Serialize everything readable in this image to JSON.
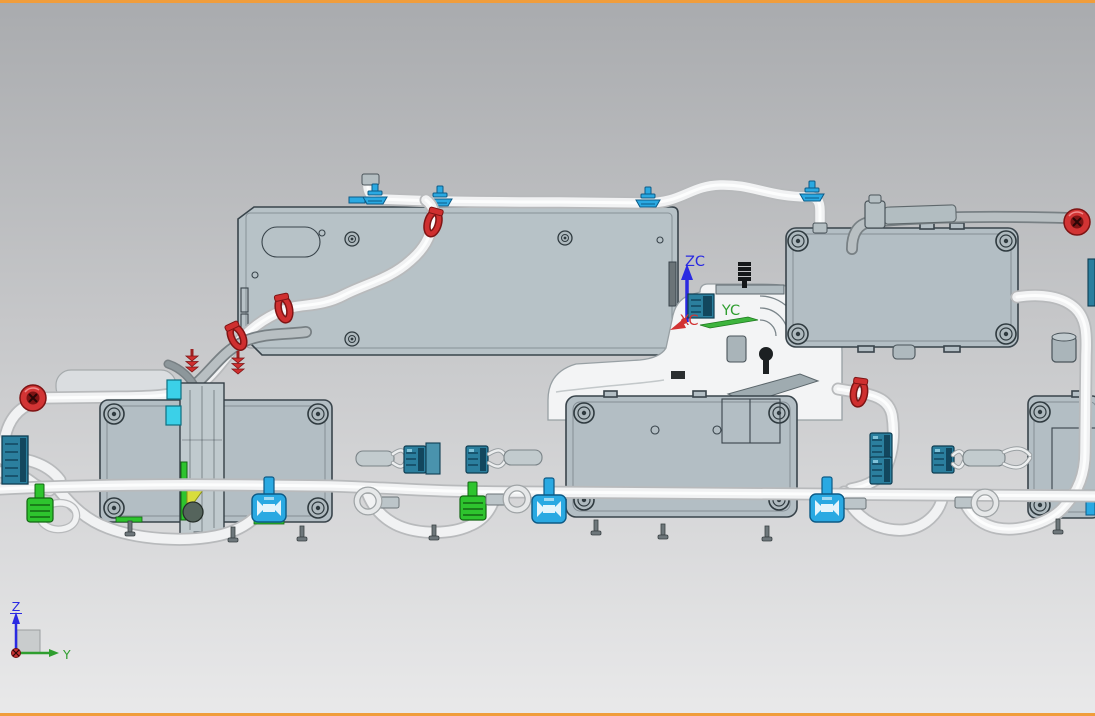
{
  "viewport": {
    "description": "CAD 3D viewport, side view of tubing and module assembly",
    "zoom_text": ""
  },
  "wcs_triad": {
    "z_axis_label": "ZC",
    "y_axis_label": "YC",
    "x_axis_label": "XC"
  },
  "absolute_triad": {
    "z_axis_label": "Z",
    "y_axis_label": "Y"
  },
  "colors": {
    "border_orange": "#f09d3b",
    "bg_top": "#a9abae",
    "bg_bottom": "#e9e9ea",
    "panel_fill": "#b7c2c7",
    "panel_stroke": "#39444b",
    "module_fill": "#b3bec4",
    "housing_fill": "#f3f4f5",
    "tube_fill": "#f1f2f3",
    "tube_edge": "#b8babc",
    "tube_gray_fill": "#b8bfc2",
    "tube_gray_edge": "#788084",
    "clip_blue": "#2aa9e2",
    "clamp_red": "#cf2f2f",
    "connector_teal": "#2b7f9e",
    "connector_teal_dark": "#12475e",
    "connector_green": "#2ec42e",
    "connector_cyan": "#3bd0e8",
    "accent_yellow": "#d8dd3c",
    "axis_z": "#2a2ae2",
    "axis_y": "#2f9e2f",
    "axis_x": "#d23333"
  }
}
